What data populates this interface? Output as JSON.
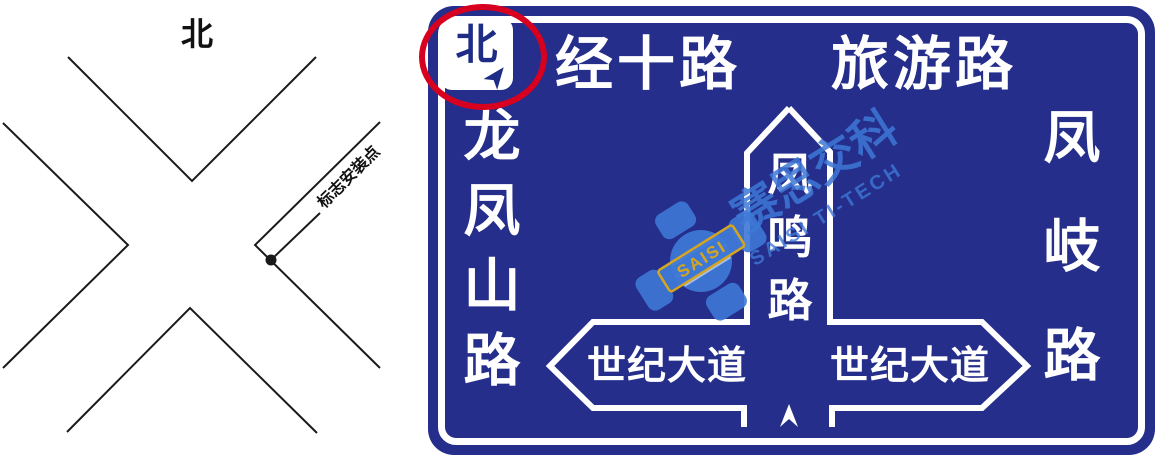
{
  "left_diagram": {
    "north_label": "北",
    "installation_point_label": "标志安装点"
  },
  "sign": {
    "north_badge": {
      "label": "北"
    },
    "top_roads": [
      {
        "label": "经十路"
      },
      {
        "label": "旅游路"
      }
    ],
    "left_road": "龙凤山路",
    "left_road_chars": [
      "龙",
      "凤",
      "山",
      "路"
    ],
    "right_road": "凤岐路",
    "right_road_chars": [
      "凤",
      "岐",
      "路"
    ],
    "center_road": "凤鸣路",
    "center_road_chars": [
      "凤",
      "鸣",
      "路"
    ],
    "left_avenue": "世纪大道",
    "right_avenue": "世纪大道"
  },
  "watermark": {
    "cn": "赛思交科",
    "en": "SAISI TI-TECH",
    "logo_text": "SAISI"
  },
  "colors": {
    "sign_blue": "#252E8B",
    "white": "#FFFFFF",
    "annotation_red": "#D8001F",
    "watermark_blue": "#3E78D6",
    "logo_gold": "#D6A51E",
    "diagram_line": "#1A1A1A"
  }
}
